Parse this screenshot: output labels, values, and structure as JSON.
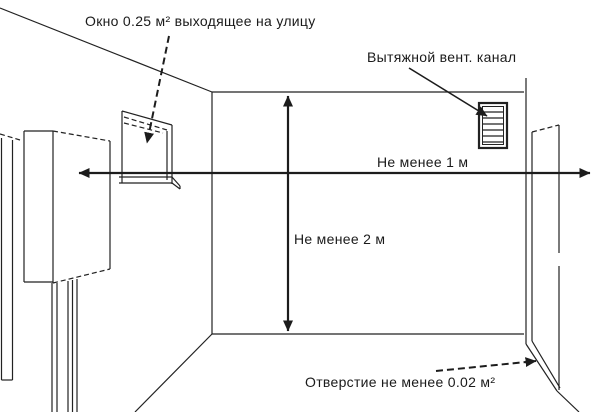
{
  "figure": {
    "background_color": "#ffffff",
    "line_color": "#222222",
    "labels": {
      "window": "Окно 0.25 м² выходящее  на улицу",
      "vent_channel": "Вытяжной вент. канал",
      "min_horizontal": "Не менее 1 м",
      "min_vertical": "Не менее 2 м",
      "door_opening": "Отверстие не менее 0.02 м²"
    },
    "measurements": {
      "window_area_m2": "0.25",
      "min_width_m": "1",
      "min_height_m": "2",
      "opening_area_m2": "0.02"
    }
  }
}
